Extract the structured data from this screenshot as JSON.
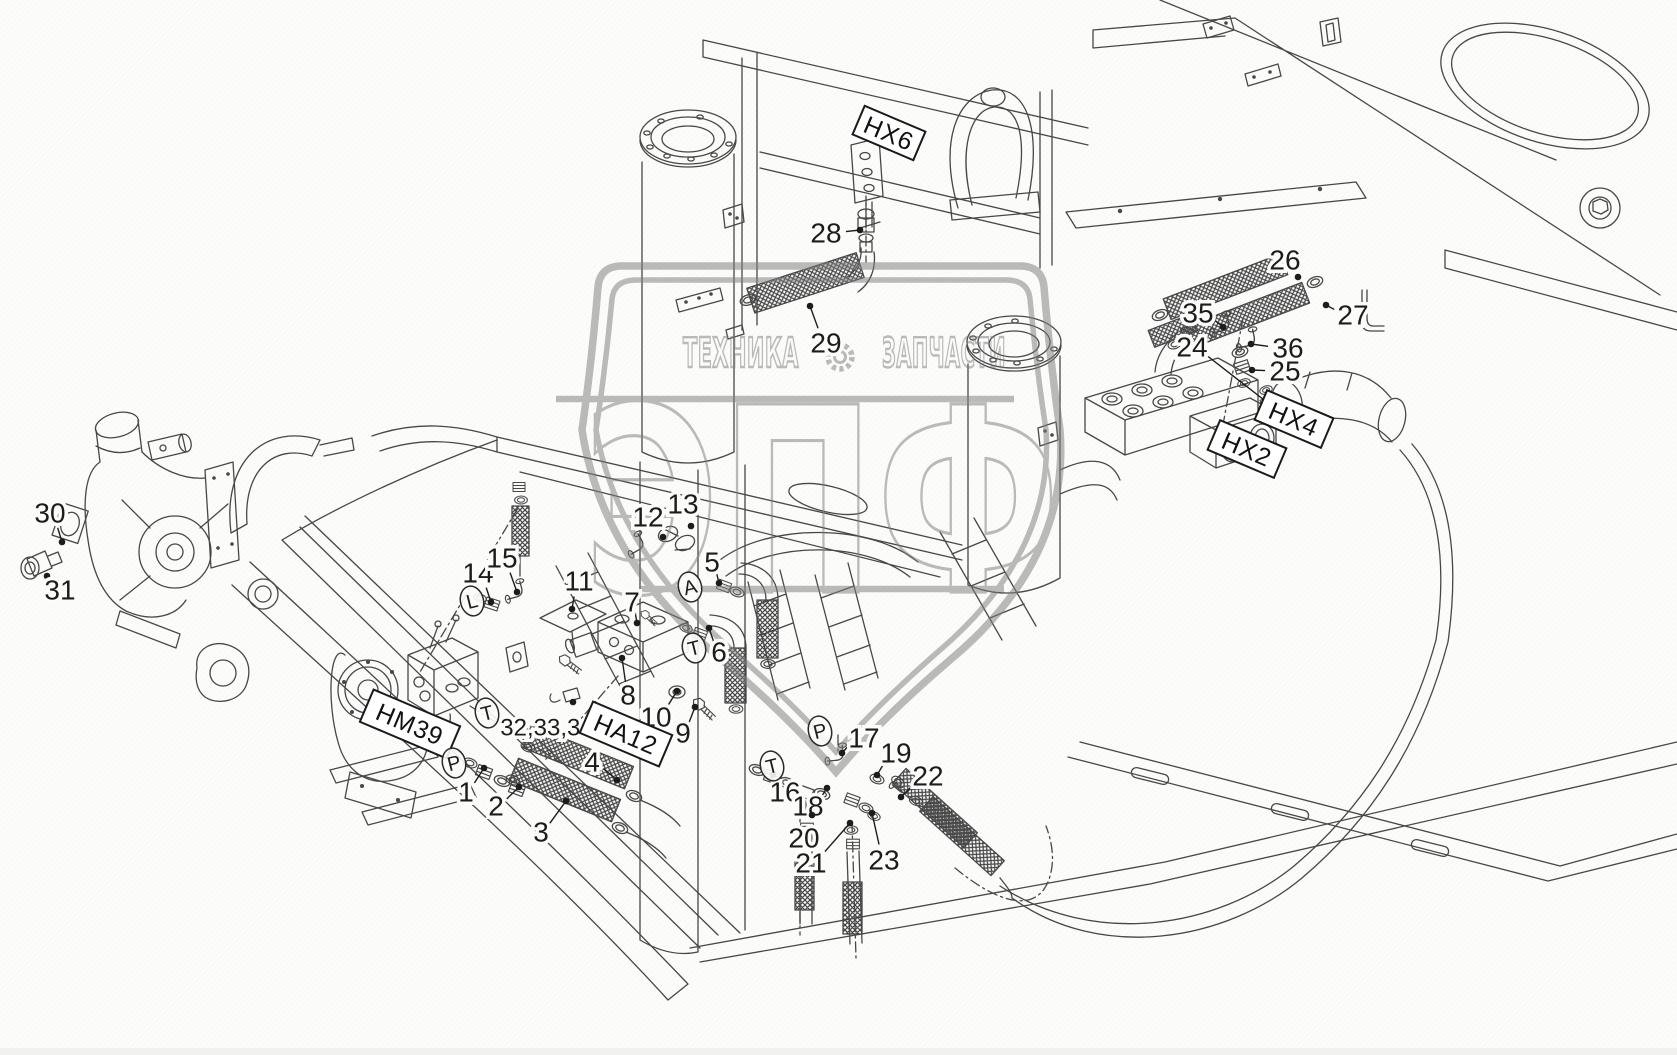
{
  "watermark": {
    "top_left_word": "ТЕХНИКА",
    "top_right_word": "ЗАПЧАСТИ",
    "big_word": "ЭПФ",
    "gear_icon": "gear-icon",
    "color": "#7e7e7e"
  },
  "colors": {
    "line": "#474747",
    "callout_text": "#1c1c1c",
    "label_box_bg": "#ffffff"
  },
  "labels": {
    "boxed": [
      {
        "text": "HX6",
        "x": 889,
        "y": 133,
        "w": 66,
        "h": 31,
        "rot": 23
      },
      {
        "text": "HM39",
        "x": 410,
        "y": 724,
        "w": 94,
        "h": 35,
        "rot": 23
      },
      {
        "text": "HA12",
        "x": 626,
        "y": 734,
        "w": 86,
        "h": 34,
        "rot": 23
      },
      {
        "text": "HX4",
        "x": 1294,
        "y": 419,
        "w": 72,
        "h": 32,
        "rot": 23
      },
      {
        "text": "HX2",
        "x": 1247,
        "y": 449,
        "w": 72,
        "h": 32,
        "rot": 23
      }
    ],
    "ports": [
      {
        "text": "L",
        "x": 472,
        "y": 601
      },
      {
        "text": "T",
        "x": 487,
        "y": 713
      },
      {
        "text": "P",
        "x": 454,
        "y": 763
      },
      {
        "text": "A",
        "x": 690,
        "y": 587
      },
      {
        "text": "T",
        "x": 694,
        "y": 648
      },
      {
        "text": "P",
        "x": 820,
        "y": 731
      },
      {
        "text": "T",
        "x": 772,
        "y": 766
      }
    ],
    "callouts": [
      {
        "text": "1",
        "x": 466,
        "y": 792,
        "tx": 484,
        "ty": 768
      },
      {
        "text": "2",
        "x": 496,
        "y": 806,
        "tx": 519,
        "ty": 787
      },
      {
        "text": "3",
        "x": 541,
        "y": 832,
        "tx": 566,
        "ty": 801
      },
      {
        "text": "4",
        "x": 592,
        "y": 762,
        "tx": 617,
        "ty": 780
      },
      {
        "text": "5",
        "x": 712,
        "y": 562,
        "tx": 719,
        "ty": 583
      },
      {
        "text": "6",
        "x": 719,
        "y": 652,
        "tx": 709,
        "ty": 628
      },
      {
        "text": "7",
        "x": 632,
        "y": 602,
        "tx": 637,
        "ty": 623
      },
      {
        "text": "8",
        "x": 628,
        "y": 695,
        "tx": 622,
        "ty": 658
      },
      {
        "text": "9",
        "x": 683,
        "y": 733,
        "tx": 695,
        "ty": 707
      },
      {
        "text": "10",
        "x": 656,
        "y": 717,
        "tx": 677,
        "ty": 691
      },
      {
        "text": "11",
        "x": 579,
        "y": 581,
        "tx": 572,
        "ty": 609
      },
      {
        "text": "12",
        "x": 648,
        "y": 517,
        "tx": 663,
        "ty": 537
      },
      {
        "text": "13",
        "x": 683,
        "y": 504,
        "tx": 691,
        "ty": 526
      },
      {
        "text": "14",
        "x": 478,
        "y": 573,
        "tx": 491,
        "ty": 602
      },
      {
        "text": "15",
        "x": 502,
        "y": 558,
        "tx": 517,
        "ty": 592
      },
      {
        "text": "16",
        "x": 785,
        "y": 792,
        "tx": 773,
        "ty": 775
      },
      {
        "text": "17",
        "x": 864,
        "y": 738,
        "tx": 842,
        "ty": 753
      },
      {
        "text": "18",
        "x": 808,
        "y": 806,
        "tx": 827,
        "ty": 788
      },
      {
        "text": "19",
        "x": 896,
        "y": 753,
        "tx": 877,
        "ty": 775
      },
      {
        "text": "20",
        "x": 804,
        "y": 838,
        "tx": 812,
        "ty": 815
      },
      {
        "text": "21",
        "x": 811,
        "y": 863,
        "tx": 850,
        "ty": 823
      },
      {
        "text": "22",
        "x": 928,
        "y": 776,
        "tx": 901,
        "ty": 797
      },
      {
        "text": "23",
        "x": 884,
        "y": 860,
        "tx": 872,
        "ty": 813
      },
      {
        "text": "24",
        "x": 1192,
        "y": 347,
        "tx": 1268,
        "ty": 403
      },
      {
        "text": "25",
        "x": 1285,
        "y": 371,
        "tx": 1252,
        "ty": 370
      },
      {
        "text": "26",
        "x": 1285,
        "y": 260,
        "tx": 1298,
        "ty": 277
      },
      {
        "text": "27",
        "x": 1353,
        "y": 315,
        "tx": 1326,
        "ty": 305
      },
      {
        "text": "28",
        "x": 826,
        "y": 233,
        "tx": 860,
        "ty": 230
      },
      {
        "text": "29",
        "x": 826,
        "y": 343,
        "tx": 810,
        "ty": 306
      },
      {
        "text": "30",
        "x": 50,
        "y": 513,
        "tx": 62,
        "ty": 542
      },
      {
        "text": "31",
        "x": 60,
        "y": 590,
        "tx": 47,
        "ty": 576
      },
      {
        "text": "32,33,34",
        "x": 547,
        "y": 728,
        "tx": 573,
        "ty": 702
      },
      {
        "text": "35",
        "x": 1198,
        "y": 313,
        "tx": 1223,
        "ty": 327
      },
      {
        "text": "36",
        "x": 1288,
        "y": 348,
        "tx": 1251,
        "ty": 344
      }
    ]
  }
}
